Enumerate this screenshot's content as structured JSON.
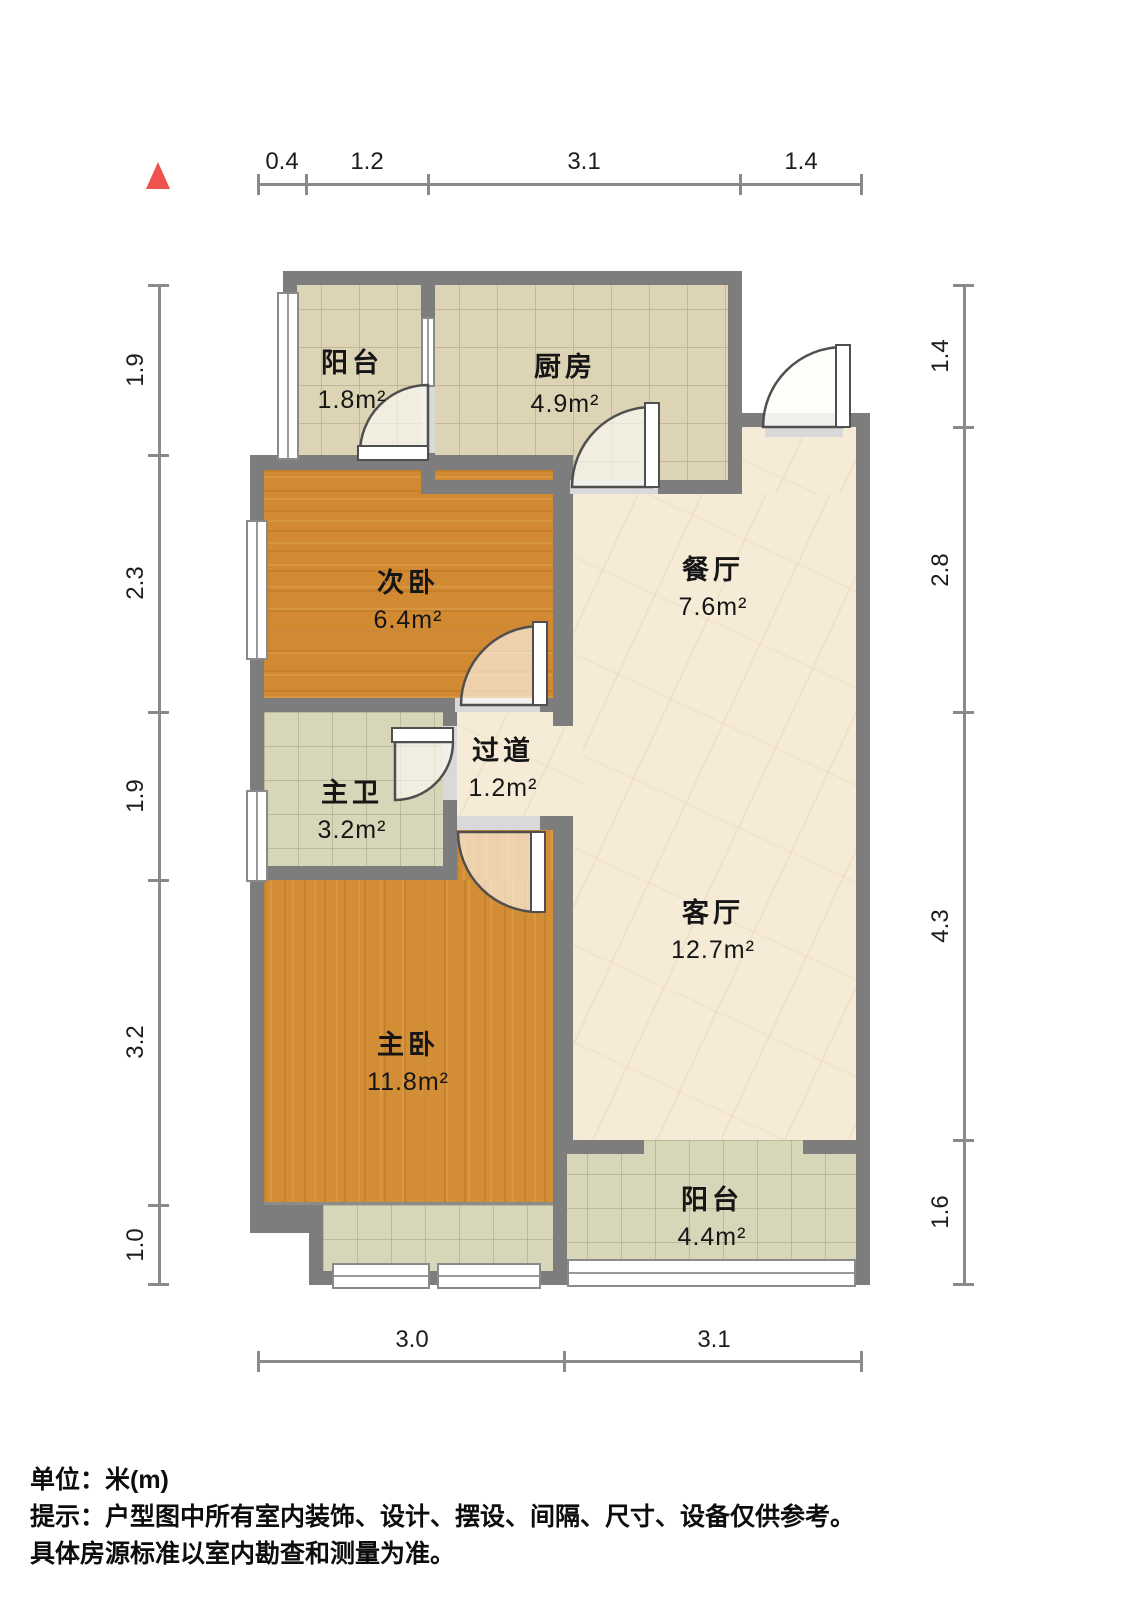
{
  "plan": {
    "title": "户型图",
    "unit": "米(m)"
  },
  "rooms": [
    {
      "id": "balcony-top",
      "name": "阳台",
      "area": "1.8m²"
    },
    {
      "id": "kitchen",
      "name": "厨房",
      "area": "4.9m²"
    },
    {
      "id": "bedroom-secondary",
      "name": "次卧",
      "area": "6.4m²"
    },
    {
      "id": "dining",
      "name": "餐厅",
      "area": "7.6m²"
    },
    {
      "id": "bathroom-master",
      "name": "主卫",
      "area": "3.2m²"
    },
    {
      "id": "hallway",
      "name": "过道",
      "area": "1.2m²"
    },
    {
      "id": "living",
      "name": "客厅",
      "area": "12.7m²"
    },
    {
      "id": "bedroom-master",
      "name": "主卧",
      "area": "11.8m²"
    },
    {
      "id": "balcony-bottom",
      "name": "阳台",
      "area": "4.4m²"
    }
  ],
  "dimensions": {
    "top": [
      "0.4",
      "1.2",
      "3.1",
      "1.4"
    ],
    "left": [
      "1.9",
      "2.3",
      "1.9",
      "3.2",
      "1.0"
    ],
    "right": [
      "1.4",
      "2.8",
      "4.3",
      "1.6"
    ],
    "bottom": [
      "3.0",
      "3.1"
    ]
  },
  "footer": {
    "line1": "单位：米(m)",
    "line2": "提示：户型图中所有室内装饰、设计、摆设、间隔、尺寸、设备仅供参考。",
    "line3": "具体房源标准以室内勘查和测量为准。"
  },
  "icons": {
    "north_arrow": "north-arrow"
  },
  "colors": {
    "wall": "#7d7d7d",
    "wood": "#d18a31",
    "marble": "#f5ebd6",
    "tile": "#ddd4b6",
    "bath_tile": "#d8d6b9",
    "north_arrow": "#ee544d",
    "dimension_line": "#8a8a8a",
    "text": "#161616"
  }
}
